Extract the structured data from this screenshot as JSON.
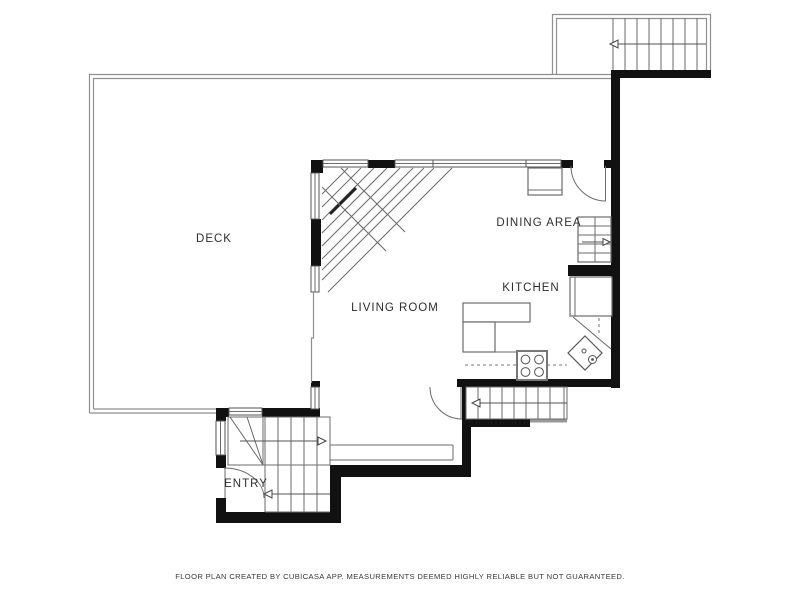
{
  "plan": {
    "rooms": {
      "deck": {
        "label": "DECK"
      },
      "living": {
        "label": "LIVING ROOM"
      },
      "dining": {
        "label": "DINING AREA"
      },
      "kitchen": {
        "label": "KITCHEN"
      },
      "entry": {
        "label": "ENTRY"
      }
    },
    "footer": "FLOOR PLAN CREATED BY CUBICASA APP. MEASUREMENTS DEEMED HIGHLY RELIABLE BUT NOT GUARANTEED.",
    "colors": {
      "background": "#ffffff",
      "wall": "#111111",
      "line": "#555555",
      "railing": "#8f8f8f",
      "label_text": "#2e2e2e",
      "footer_text": "#3a3a3a"
    }
  }
}
